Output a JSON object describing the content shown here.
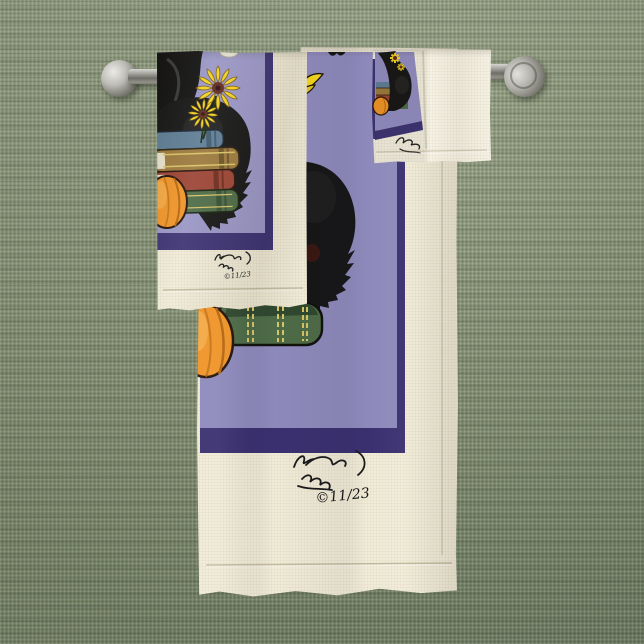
{
  "scene": {
    "type": "product-photo",
    "subject": "Halloween black cat towel set hanging on towel bars",
    "background": {
      "fabric": "woven linen",
      "base_color": "#8a9579",
      "thread_light": "#9aa489",
      "thread_dark": "#6e7d62"
    }
  },
  "hardware": {
    "finish": "brushed nickel",
    "left_bar": {
      "end": "ball finial"
    },
    "right_bar": {
      "end": "round wall mount"
    }
  },
  "towels": [
    {
      "id": "bath-towel",
      "label": "Bath towel",
      "fabric_color": "#f1ecd8",
      "panel_color": "#8d89ba",
      "border_color": "#3a3070"
    },
    {
      "id": "hand-towel",
      "label": "Hand towel",
      "fabric_color": "#f2edda",
      "panel_color": "#9a96c6",
      "border_color": "#3c3273"
    },
    {
      "id": "washcloth",
      "label": "Washcloth",
      "fabric_color": "#f5f1e2",
      "panel_color": "#908cc0",
      "border_color": "#3c3273"
    }
  ],
  "artwork": {
    "motifs": [
      "black cat",
      "witch hat",
      "stack of books",
      "pumpkin",
      "yellow flowers"
    ],
    "colors": {
      "cat": "#161616",
      "pumpkin": "#ef9428",
      "pumpkin_shade": "#b5660f",
      "pumpkin_highlight": "#f8b95c",
      "flower_petal": "#f2d321",
      "flower_center": "#5f2a1e",
      "book_blue": "#5e7d95",
      "book_tan": "#9c7a3c",
      "book_red": "#9c4434",
      "book_green": "#4d6b46",
      "book_gold_trim": "#d8c468"
    }
  },
  "signature": {
    "description": "handwritten artist signature on cream hem",
    "copyright": "©11/23"
  }
}
